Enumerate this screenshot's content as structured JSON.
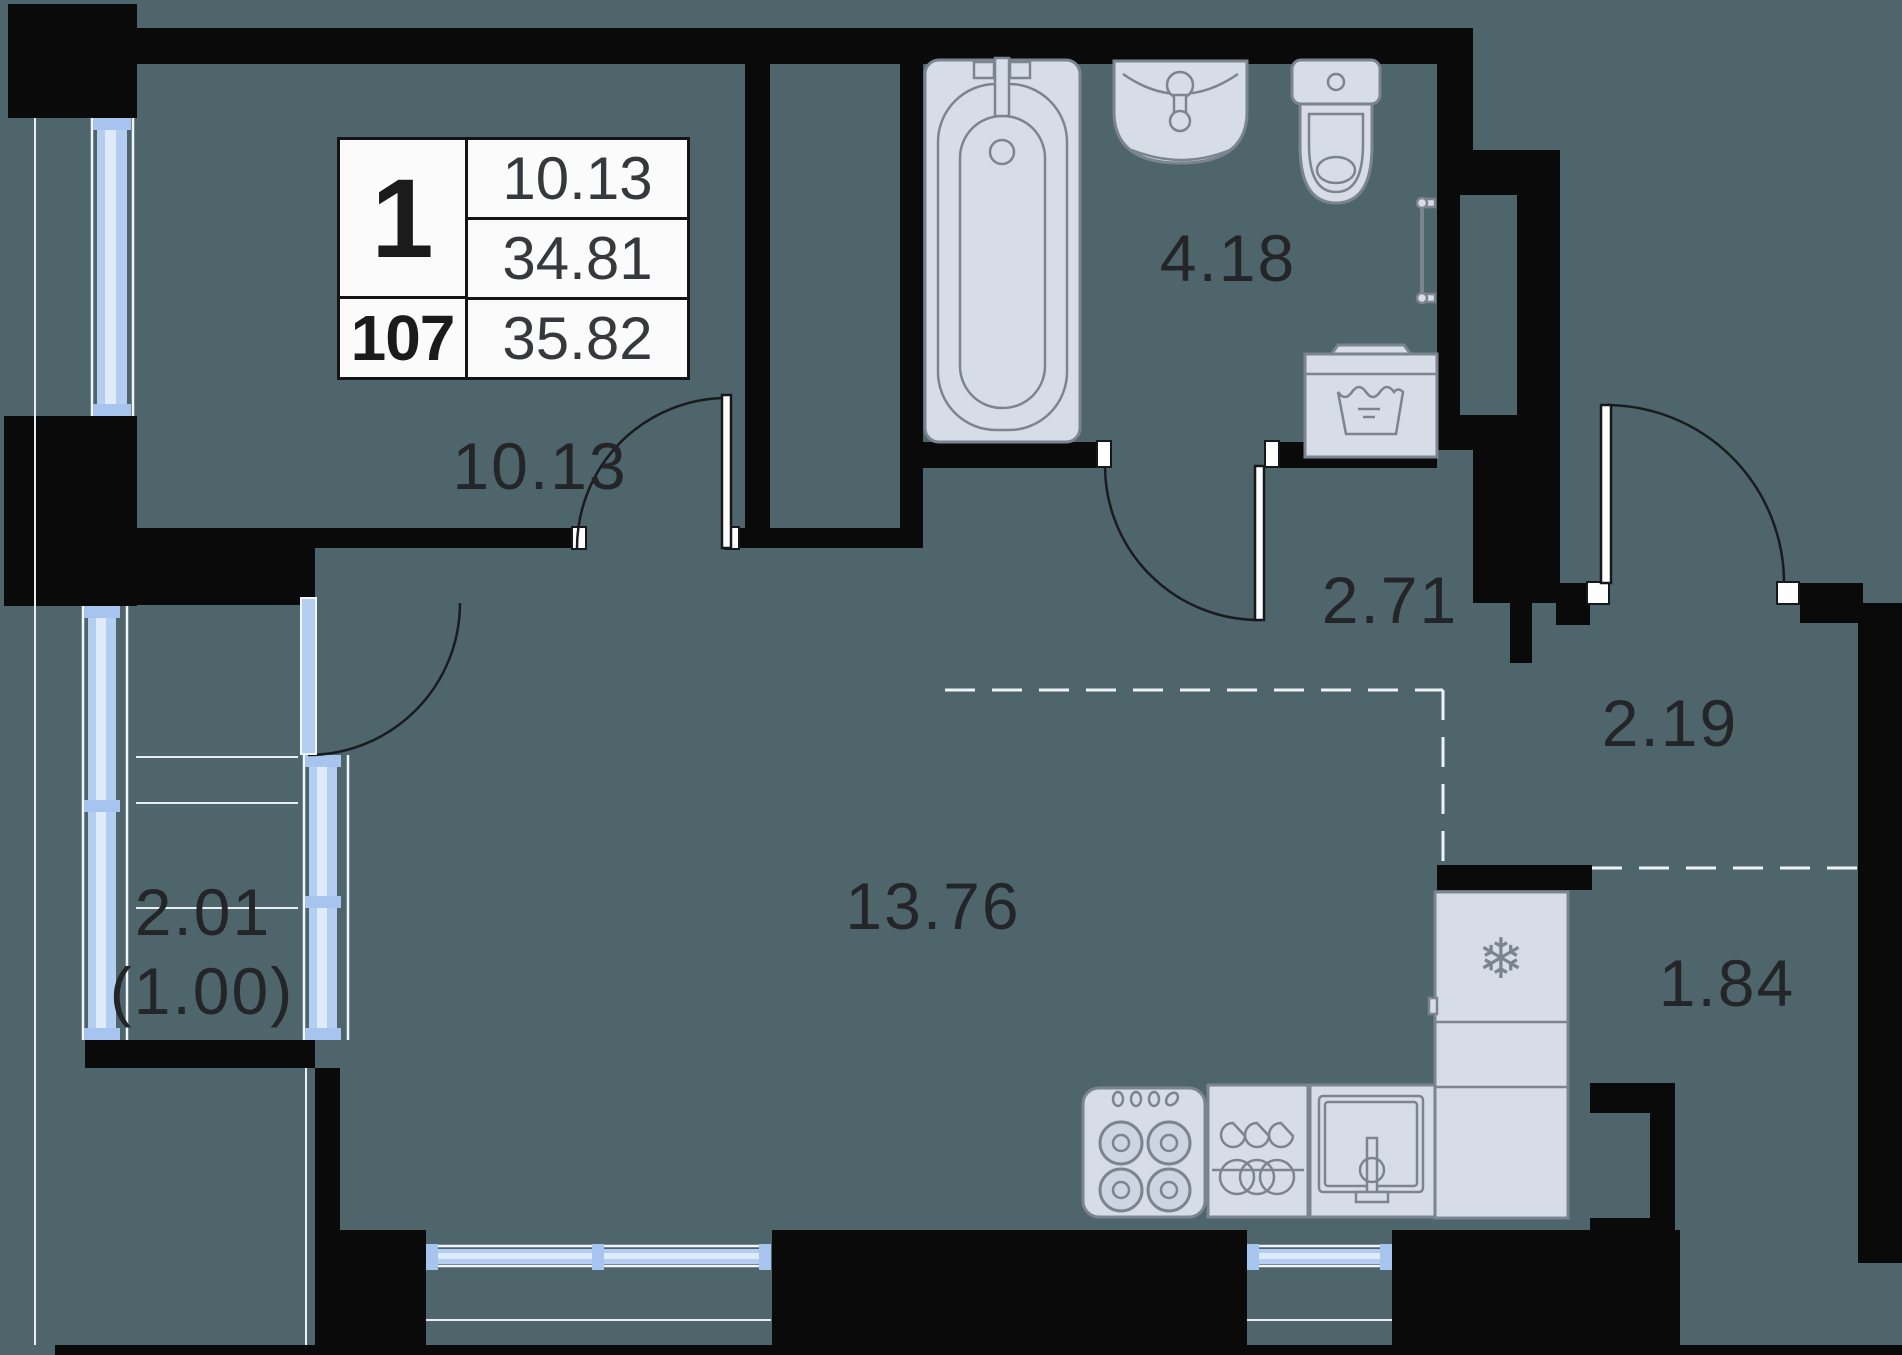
{
  "unit": {
    "rooms_count": "1",
    "number": "107",
    "row_area": "10.13",
    "living_total_area": "34.81",
    "total_area": "35.82"
  },
  "rooms": {
    "living": {
      "label": "10.13"
    },
    "bathroom": {
      "label": "4.18"
    },
    "hallway": {
      "label": "2.71"
    },
    "entry": {
      "label": "2.19"
    },
    "main": {
      "label": "13.76"
    },
    "wardrobe": {
      "label": "1.84"
    },
    "balcony": {
      "label": "2.01",
      "label_secondary": "(1.00)"
    }
  },
  "icons": {
    "snowflake": "❄"
  },
  "colors": {
    "floor": "#4e656c",
    "wall": "#0a0a0a",
    "fixture_fill": "#d7dde7",
    "fixture_stroke": "#7a8590",
    "window_blue": "#b3cef1",
    "label_text": "#232529"
  }
}
